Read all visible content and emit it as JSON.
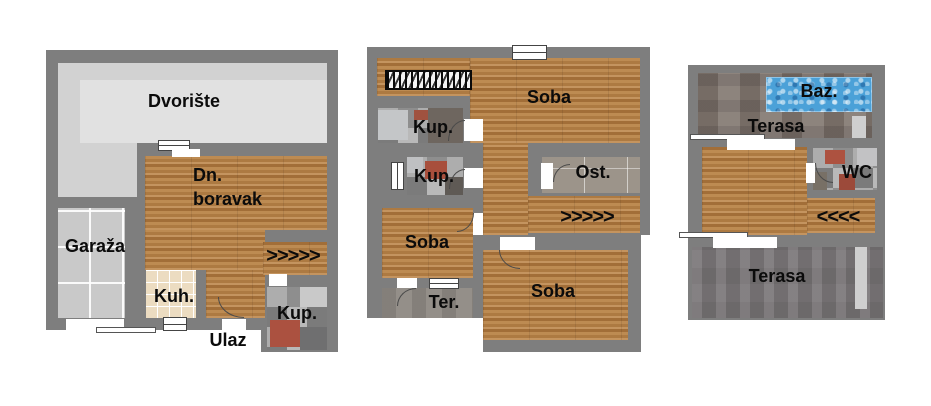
{
  "document": {
    "kind": "apartment floor plan, 3 levels",
    "language": "hr"
  },
  "colors": {
    "wall": "#7e7e7e",
    "wood_floor": "#b5834f",
    "yard": "#d2d2d2",
    "yard_inner": "#e1e1e1",
    "garage": "#c9c9c9",
    "kitchen_tile": "#ecdcc1",
    "bath_tile_red_accent": "#a84f3c",
    "pool_water": "#4ba1d8",
    "terrace_dark": "#7d797b",
    "terrace_brown": "#877d76"
  },
  "floors": {
    "ground": {
      "dvoriste": "Dvorište",
      "living_line1": "Dn.",
      "living_line2": "boravak",
      "garaza": "Garaža",
      "kuhinja": "Kuh.",
      "kupaonica": "Kup.",
      "ulaz": "Ulaz",
      "stairs_up": ">>>>>"
    },
    "first": {
      "soba_top": "Soba",
      "kupaonica_1": "Kup.",
      "kupaonica_2": "Kup.",
      "ostava": "Ost.",
      "stairs_up": ">>>>>",
      "soba_left": "Soba",
      "terasa": "Ter.",
      "soba_bottom": "Soba"
    },
    "attic": {
      "bazen": "Baz.",
      "terasa_upper": "Terasa",
      "wc": "WC",
      "stairs_down": "<<<<",
      "terasa_lower": "Terasa"
    }
  }
}
